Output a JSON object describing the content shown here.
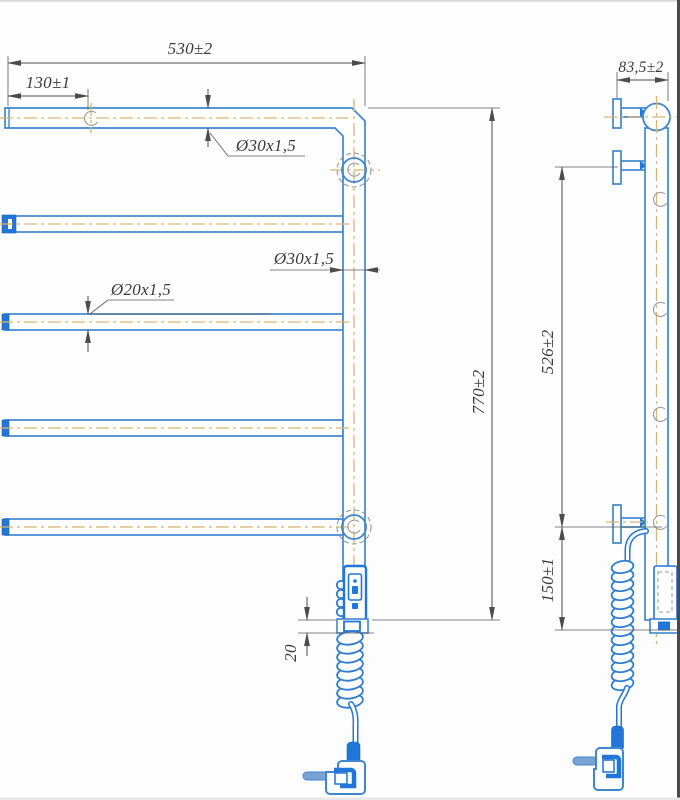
{
  "drawing": {
    "type": "technical drawing — electric heated towel rail, front and side views",
    "colors": {
      "outline_blue": "#3f86cf",
      "solid_blue": "#2176d9",
      "centerline_tan": "#d8b472",
      "dimension_gray": "#4c4c4c",
      "background": "#fdfdfd"
    },
    "front_view": {
      "dims": {
        "overall_width": "530±2",
        "bracket_offset": "130±1",
        "top_tube": "Ø30x1,5",
        "post_tube": "Ø30x1,5",
        "rung_tube": "Ø20x1,5",
        "overall_height": "770±2",
        "controller_clearance": "20"
      }
    },
    "side_view": {
      "dims": {
        "depth": "83,5±2",
        "bracket_spacing": "526±2",
        "bracket_to_bottom": "150±1"
      }
    }
  }
}
